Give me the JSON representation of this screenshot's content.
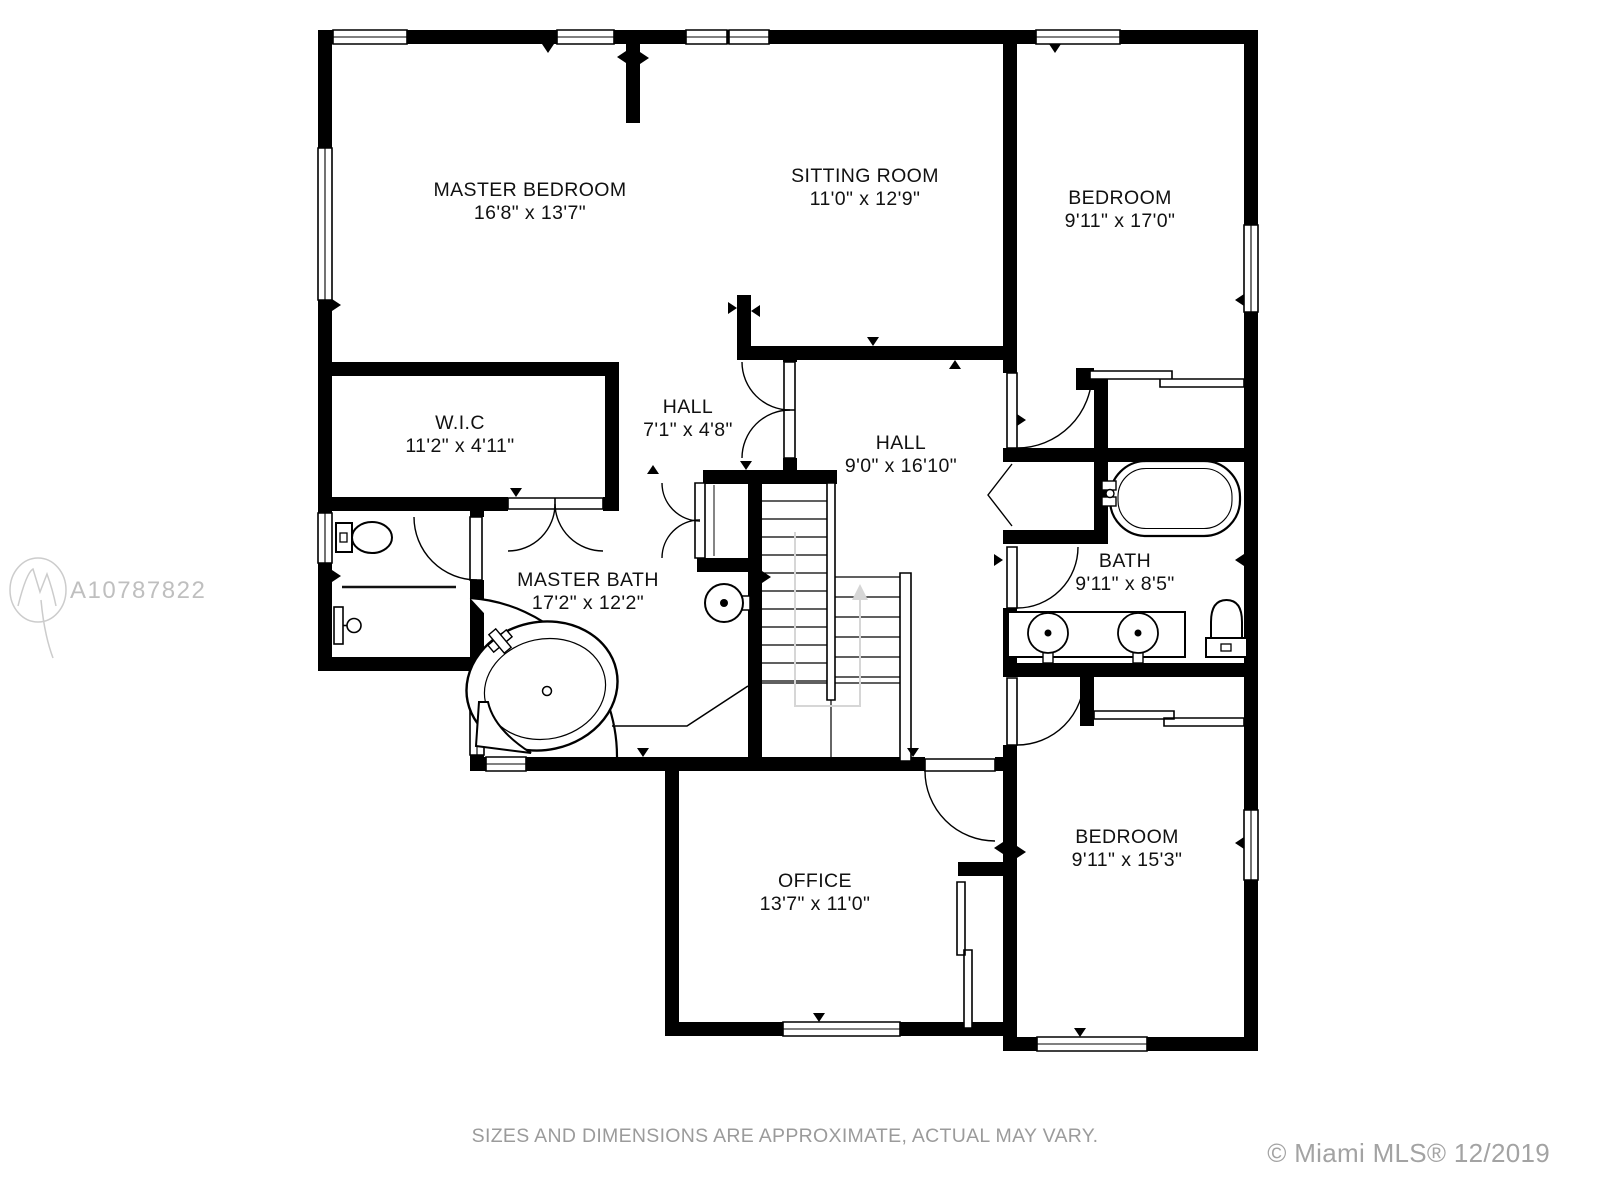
{
  "watermark": {
    "id": "A10787822"
  },
  "footer": {
    "disclaimer": "SIZES AND DIMENSIONS ARE APPROXIMATE, ACTUAL MAY VARY.",
    "credit": "© Miami MLS® 12/2019"
  },
  "colors": {
    "wall": "#000000",
    "label": "#111111",
    "muted": "#9b9b9b",
    "watermark": "#bfbfbf",
    "stair_guide": "#d6d6d6"
  },
  "rooms": [
    {
      "id": "master-bedroom",
      "name": "MASTER BEDROOM",
      "dims": "16'8\" x 13'7\""
    },
    {
      "id": "sitting-room",
      "name": "SITTING ROOM",
      "dims": "11'0\" x 12'9\""
    },
    {
      "id": "bedroom-top",
      "name": "BEDROOM",
      "dims": "9'11\" x 17'0\""
    },
    {
      "id": "wic",
      "name": "W.I.C",
      "dims": "11'2\" x 4'11\""
    },
    {
      "id": "hall-small",
      "name": "HALL",
      "dims": "7'1\" x 4'8\""
    },
    {
      "id": "hall-main",
      "name": "HALL",
      "dims": "9'0\" x 16'10\""
    },
    {
      "id": "master-bath",
      "name": "MASTER BATH",
      "dims": "17'2\" x 12'2\""
    },
    {
      "id": "bath",
      "name": "BATH",
      "dims": "9'11\" x 8'5\""
    },
    {
      "id": "bedroom-bottom",
      "name": "BEDROOM",
      "dims": "9'11\" x 15'3\""
    },
    {
      "id": "office",
      "name": "OFFICE",
      "dims": "13'7\" x 11'0\""
    }
  ],
  "fixtures": [
    "corner-tub",
    "pedestal-sink",
    "toilet",
    "shower-head",
    "bathtub",
    "double-vanity-sinks",
    "staircase",
    "sliding-closet-doors",
    "bifold-closet-doors"
  ]
}
